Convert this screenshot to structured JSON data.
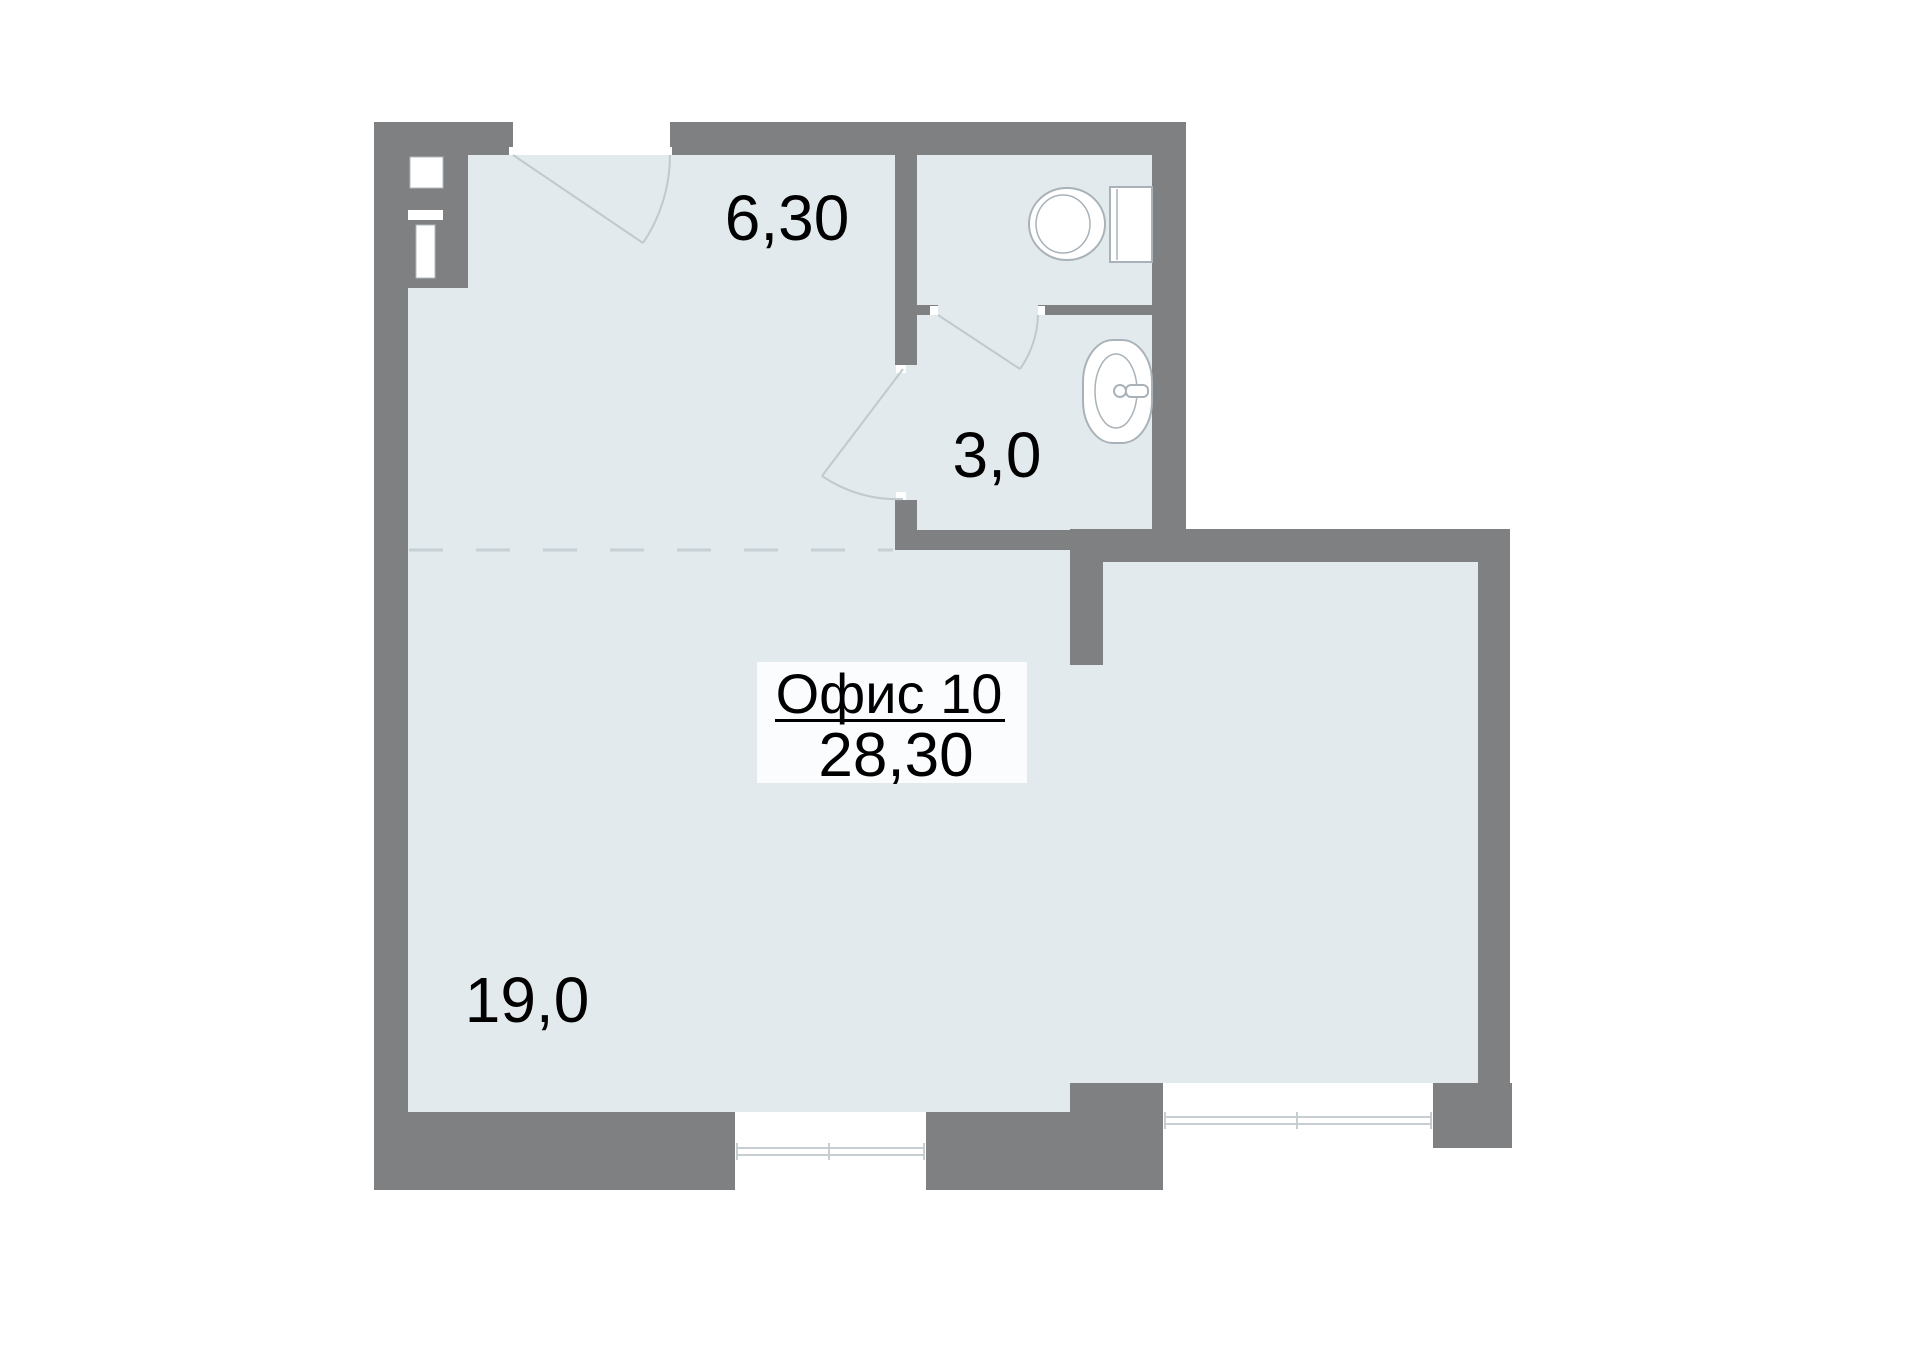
{
  "floorplan": {
    "office_label": {
      "title": "Офис 10",
      "area": "28,30"
    },
    "room_areas": {
      "entry": "6,30",
      "bathroom": "3,0",
      "main": "19,0"
    },
    "icons": [
      "toilet-icon",
      "sink-icon",
      "ventilation-shaft-icon"
    ],
    "colors": {
      "wall": "#7f8081",
      "floor": "#e3eaed",
      "outside": "#ffffff",
      "label_box": "#fbfcfd",
      "fixture_outline": "#a8b2b8",
      "door_line": "#bfc9ce",
      "dashed_divider": "#c6d0d5",
      "text": "#000000"
    }
  }
}
